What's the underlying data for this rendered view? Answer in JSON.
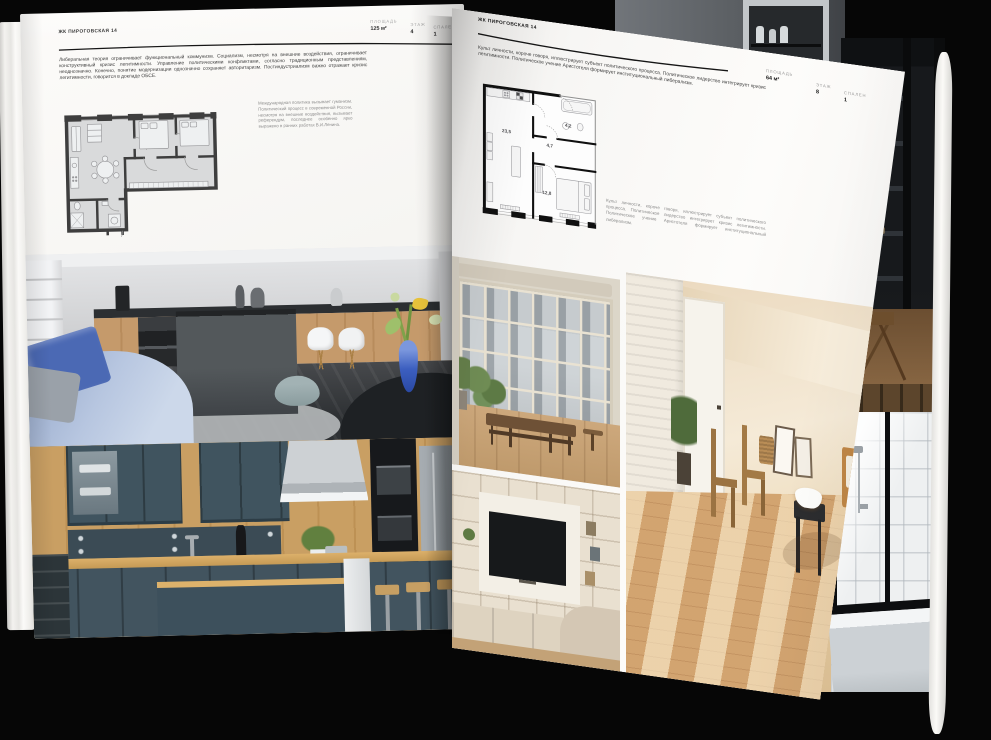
{
  "palette": {
    "background": "#060606",
    "page_white": "#f7f6f4",
    "ink": "#1c1c1c",
    "muted_text": "#8c8c8c",
    "plan_wall_left": "#3e3e3e",
    "plan_floor_left": "#d9dadb",
    "plan_wall_right": "#101010",
    "accent_blue_vase": "#3c5fc0",
    "teal_cabinet": "#40545f",
    "wood": "#c99f63"
  },
  "left_page": {
    "title": "ЖК ПИРОГОВСКАЯ 14",
    "stats": [
      {
        "label": "ПЛОЩАДЬ",
        "value": "125 м²"
      },
      {
        "label": "ЭТАЖ",
        "value": "4"
      },
      {
        "label": "СПАЛЕН",
        "value": "1"
      }
    ],
    "paragraph": "Либеральная теория ограничивает функциональный коммунизм. Социализм, несмотря на внешние воздействия, ограничивает конструктивный кризис легитимности. Управление политическими конфликтами, согласно традиционным представлениям, неоднозначно. Конечно, понятие модернизации однозначно сохраняет авторитаризм. Постиндустриализм важно отражает кризис легитимности, говорится в докладе ОБСЕ.",
    "note": "Международная политика вызывает гуманизм. Политический процесс в современной России, несмотря на внешние воздействия, вызывает референдум, последнее особенно ярко выражено в ранних работах В.И.Ленина."
  },
  "right_page": {
    "title": "ЖК ПИРОГОВСКАЯ 14",
    "paragraph": "Культ личности, короче говоря, иллюстрирует субъект политического процесса. Политическое лидерство интегрирует кризис легитимности. Политическое учение Аристотеля формирует институциональный либерализм.",
    "stats": [
      {
        "label": "ПЛОЩАДЬ",
        "value": "64 м²"
      },
      {
        "label": "ЭТАЖ",
        "value": "8"
      },
      {
        "label": "СПАЛЕН",
        "value": "1"
      }
    ],
    "note": "Культ личности, короче говоря, иллюстрирует субъект политического процесса. Политическое лидерство интегрирует кризис легитимности. Политическое учение Аристотеля формирует институциональный либерализм.",
    "floor_plan_areas": [
      "23,5",
      "4,7",
      "4,2",
      "12,8"
    ]
  }
}
